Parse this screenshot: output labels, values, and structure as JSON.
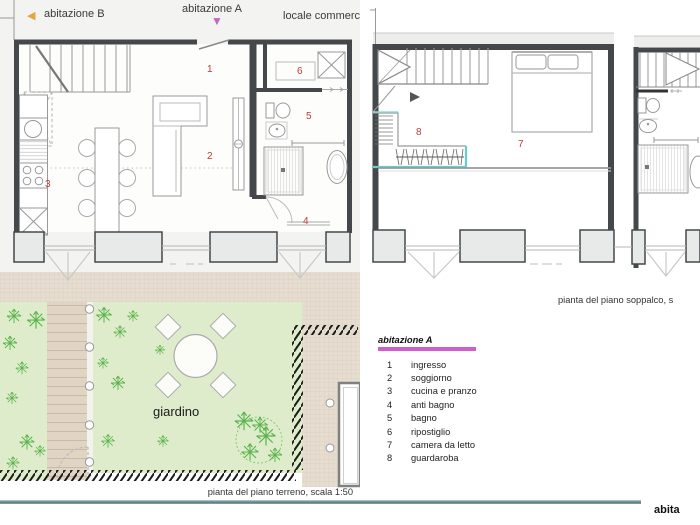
{
  "header": {
    "abitazione_b_label": "abitazione B",
    "abitazione_a_label": "abitazione A",
    "locale_label": "locale commerc",
    "arrow_left_glyph": "◀",
    "arrow_down_glyph": "▼"
  },
  "plan_ground": {
    "caption": "pianta del piano terreno, scala 1:50",
    "garden_label": "giardino"
  },
  "plan_mezzanine": {
    "caption": "pianta del piano soppalco, s"
  },
  "legend": {
    "title": "abitazione A",
    "items": [
      {
        "num": "1",
        "label": "ingresso"
      },
      {
        "num": "2",
        "label": "soggiorno"
      },
      {
        "num": "3",
        "label": "cucina e pranzo"
      },
      {
        "num": "4",
        "label": "anti bagno"
      },
      {
        "num": "5",
        "label": "bagno"
      },
      {
        "num": "6",
        "label": "ripostiglio"
      },
      {
        "num": "7",
        "label": "camera da letto"
      },
      {
        "num": "8",
        "label": "guardaroba"
      }
    ]
  },
  "footer": {
    "watermark": "abita"
  },
  "colors": {
    "arrow_amber": "#e5a43f",
    "accent_magenta": "#c466c4",
    "legend_bar_magenta": "#cf5ecf",
    "room_number_red": "#c0393b",
    "wardrobe_cyan": "#62cfcf",
    "lawn_green": "#dfeccb",
    "paving_tan": "#e6dccf",
    "rule_teal": "#547e7e",
    "wall_dark": "#45484a"
  }
}
